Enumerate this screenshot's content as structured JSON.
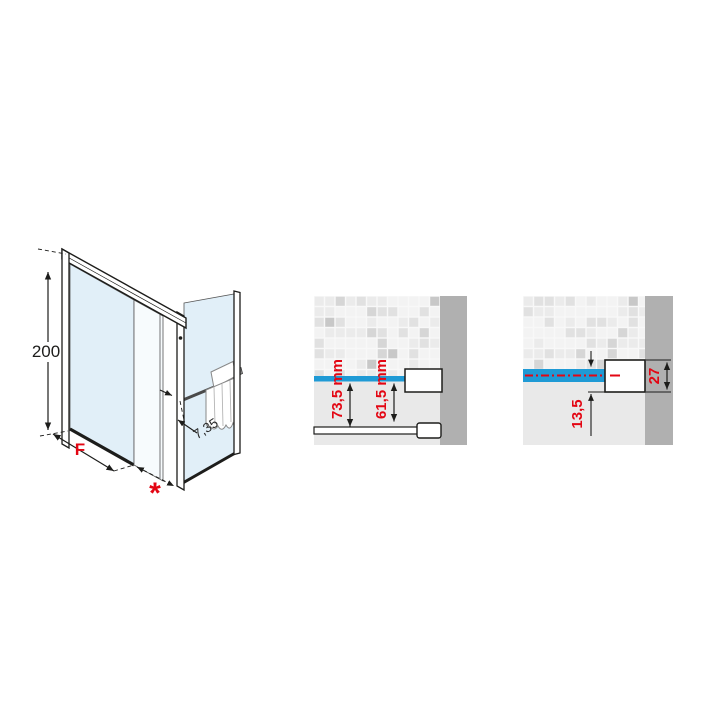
{
  "page": {
    "background": "#ffffff"
  },
  "colors": {
    "accent_red": "#e30613",
    "water_blue": "#1f9ad5",
    "glass_blue": "#e1eff8",
    "panel_background": "#e9e9e9",
    "wall_gray": "#b0b0b0",
    "line_dark": "#1d1d1b"
  },
  "isometric_drawing": {
    "type": "corner shower enclosure with sliding door, fixed side panel and towel rail",
    "height_dim": "200",
    "fixed_panel_dim": "F",
    "entry_dim": "*",
    "side_profile_dim": "7,35"
  },
  "detail_middle": {
    "subject": "wall profile cross-section on tiled wall",
    "outer_dim": "73,5 mm",
    "inner_dim": "61,5 mm"
  },
  "detail_right": {
    "subject": "wall profile adjustment cross-section on tiled wall",
    "overlap_dim": "13,5",
    "profile_dim": "27"
  }
}
